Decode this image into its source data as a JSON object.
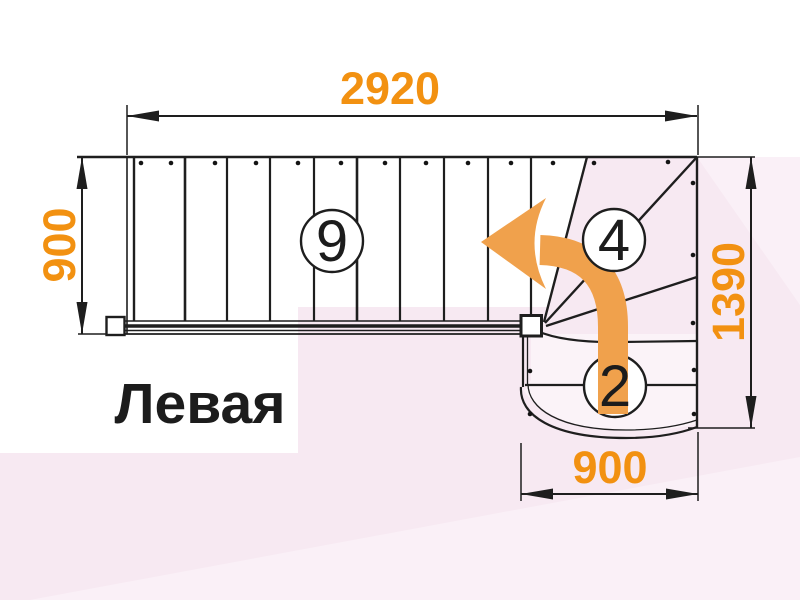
{
  "drawing": {
    "title_label": "Левая",
    "type_label": "staircase-floor-plan",
    "dimensions": {
      "top": "2920",
      "left": "900",
      "right": "1390",
      "bottom": "900"
    },
    "step_counts": {
      "main_flight": "9",
      "winders": "4",
      "bottom_flight": "2"
    },
    "icons": {
      "turn_arrow": "curved-left-turn-arrow"
    },
    "colors": {
      "dimension_text": "#F29111",
      "turn_arrow": "#F0A14C",
      "line": "#1e1e1e",
      "background_pink": "#F7E9F2",
      "background_pink_light": "#FAF0F7",
      "background_white": "#ffffff"
    }
  }
}
